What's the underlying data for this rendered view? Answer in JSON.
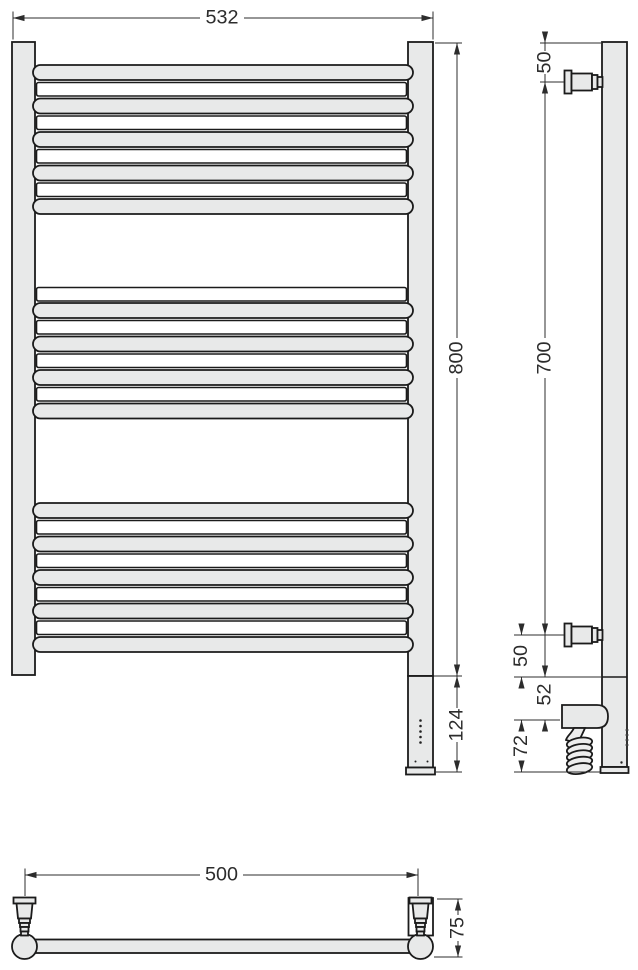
{
  "drawing": {
    "title": "towel-rail-technical-drawing",
    "views": {
      "front": "front-view",
      "side": "side-view",
      "plan": "plan-view"
    },
    "dimensions": {
      "front_width": "532",
      "front_height": "800",
      "element_height": "124",
      "side_top_offset": "50",
      "side_mount_span": "700",
      "side_bottom_offset": "50",
      "side_element_offset": "52",
      "side_cable_zone": "72",
      "plan_mount_span": "500",
      "plan_depth": "75"
    },
    "bar_groups": [
      {
        "front_bars": 5,
        "back_bars": 4
      },
      {
        "front_bars": 4,
        "back_bars": 4
      },
      {
        "front_bars": 5,
        "back_bars": 4
      }
    ],
    "element_indicator_dots": 5,
    "colors": {
      "fill": "#e8e9e9",
      "coil_fill": "#ededed",
      "outline": "#1b1b1b",
      "dim": "#2c2c2c",
      "background": "#ffffff"
    }
  }
}
